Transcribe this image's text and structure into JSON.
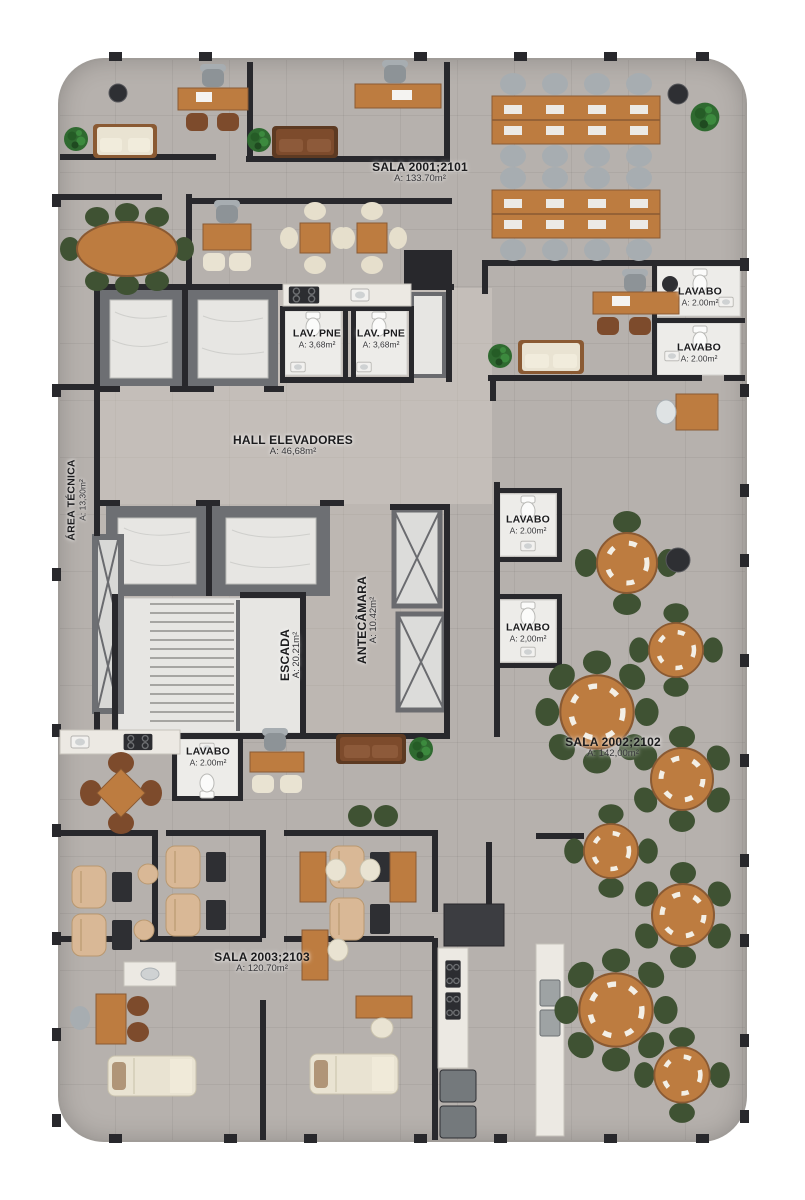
{
  "plan_title": "Pavimento tipo - planta humanizada",
  "palette": {
    "floor": "#b6b1ad",
    "wall": "#28282c",
    "wallmid": "#6d6f73",
    "wood": "#bd7c40",
    "wood2": "#8a5a33",
    "graychair": "#a7adb1",
    "green": "#3f5233",
    "brown": "#7d4b2c",
    "cream": "#e9e3d2",
    "beige": "#d9b896",
    "marble": "#e7e6e3",
    "plant": "#2f6a30",
    "dark": "#2e2f33",
    "appl": "#74797c"
  },
  "rooms": [
    {
      "id": "sala-2001",
      "name": "SALA 2001;2101",
      "area": "A: 133.70m²"
    },
    {
      "id": "lavabo-ne-1",
      "name": "LAVABO",
      "area": "A: 2.00m²"
    },
    {
      "id": "lavabo-ne-2",
      "name": "LAVABO",
      "area": "A: 2.00m²"
    },
    {
      "id": "lav-pne-1",
      "name": "LAV. PNE",
      "area": "A: 3,68m²"
    },
    {
      "id": "lav-pne-2",
      "name": "LAV. PNE",
      "area": "A: 3,68m²"
    },
    {
      "id": "hall-elevadores",
      "name": "HALL ELEVADORES",
      "area": "A: 46,68m²"
    },
    {
      "id": "area-tecnica",
      "name": "ÁREA TÉCNICA",
      "area": "A: 13,30m²"
    },
    {
      "id": "lavabo-mid-1",
      "name": "LAVABO",
      "area": "A: 2.00m²"
    },
    {
      "id": "lavabo-mid-2",
      "name": "LAVABO",
      "area": "A: 2,00m²"
    },
    {
      "id": "escada",
      "name": "ESCADA",
      "area": "A: 20.21m²"
    },
    {
      "id": "antecamara",
      "name": "ANTECÂMARA",
      "area": "A: 10.42m²"
    },
    {
      "id": "lavabo-sw",
      "name": "LAVABO",
      "area": "A: 2.00m²"
    },
    {
      "id": "sala-2002",
      "name": "SALA 2002;2102",
      "area": "A: 142,00m²"
    },
    {
      "id": "sala-2003",
      "name": "SALA 2003;2103",
      "area": "A: 120.70m²"
    }
  ]
}
